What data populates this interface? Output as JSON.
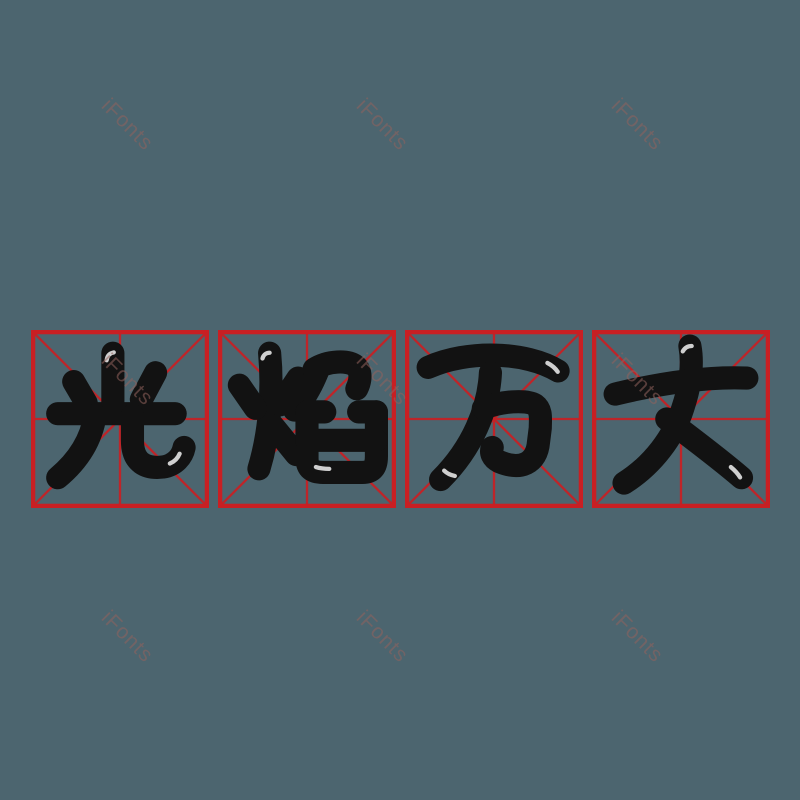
{
  "image": {
    "width_px": 800,
    "height_px": 800,
    "background_color": "#4c656f"
  },
  "phrase": {
    "text": "光焰万丈",
    "characters": [
      "光",
      "焰",
      "万",
      "丈"
    ],
    "char_color": "#121212"
  },
  "grid": {
    "style": "mizige-practice-grid",
    "box_count": 4,
    "line_color": "#c81f23",
    "box_size_px": 178,
    "row_top_px": 330,
    "box_lefts_px": [
      31,
      218,
      405,
      592
    ]
  },
  "watermark": {
    "text": "iFonts",
    "color": "#92625d",
    "opacity": 0.55,
    "rotation_deg": 45,
    "font_size_px": 21,
    "centers_px": [
      [
        127,
        125
      ],
      [
        382,
        125
      ],
      [
        637,
        125
      ],
      [
        127,
        380
      ],
      [
        382,
        380
      ],
      [
        637,
        380
      ],
      [
        127,
        637
      ],
      [
        382,
        637
      ],
      [
        637,
        637
      ]
    ]
  }
}
